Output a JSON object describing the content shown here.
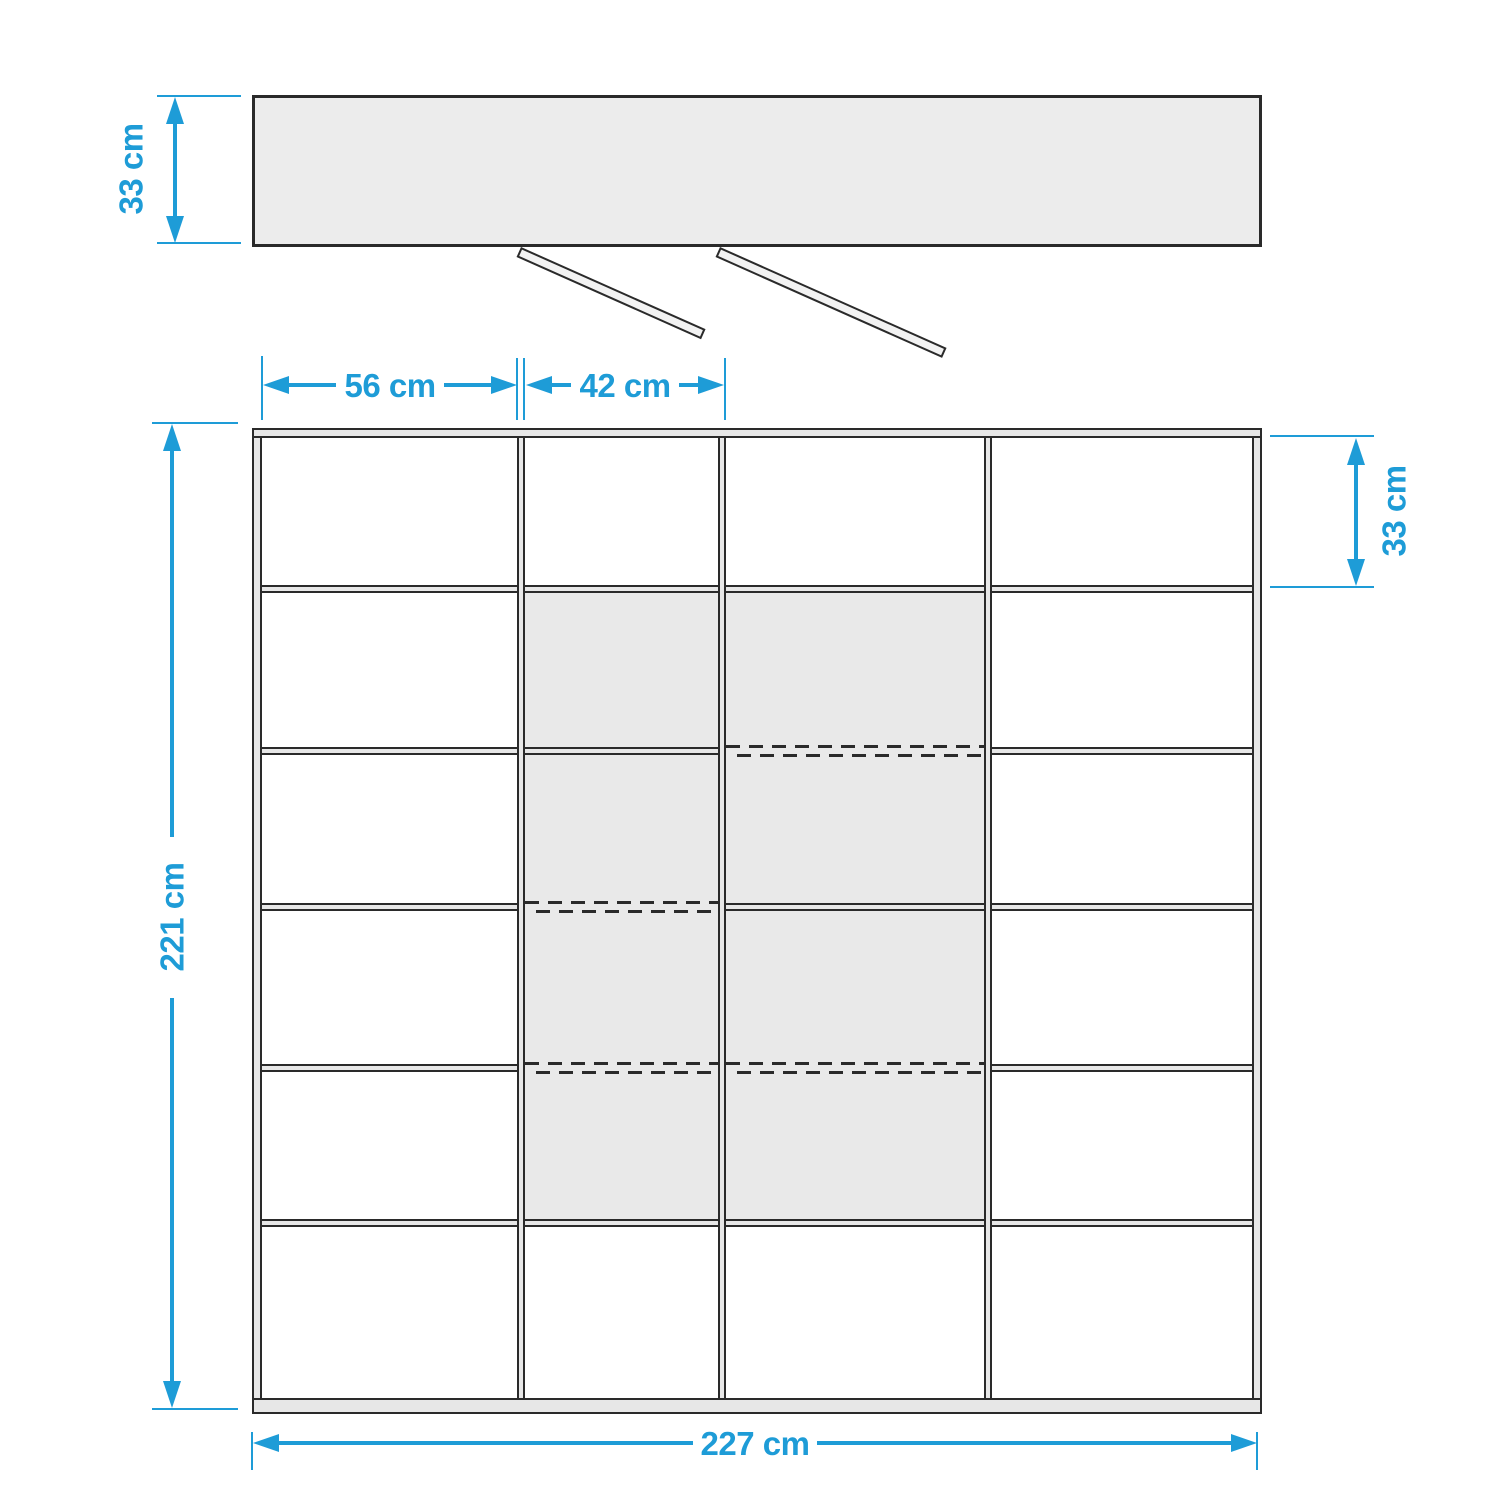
{
  "colors": {
    "accent_blue": "#1e9cd7",
    "outline_dark": "#2a2a2a",
    "panel_fill": "#e7e7e7",
    "shaded_compartment_fill": "#e9e9e9",
    "background": "#ffffff"
  },
  "top_view": {
    "description": "top view of cabinet carcass with two sliding doors shown open",
    "depth_dimension_label": "33 cm",
    "open_door_count": 2
  },
  "front_view": {
    "description": "front view of shelf unit grid",
    "grid": {
      "columns": 4,
      "rows": 6
    },
    "dimension_labels": {
      "column1_width": "56 cm",
      "column2_width": "42 cm",
      "top_row_height": "33 cm",
      "total_height": "221 cm",
      "total_width": "227 cm"
    },
    "shaded_compartments": {
      "columns": [
        2,
        3
      ],
      "rows": [
        2,
        3,
        4,
        5
      ]
    },
    "shelf_boundaries": [
      {
        "between_rows": "1-2",
        "styles_by_column": [
          "solid",
          "solid",
          "solid",
          "solid"
        ]
      },
      {
        "between_rows": "2-3",
        "styles_by_column": [
          "solid",
          "solid",
          "dashed",
          "solid"
        ]
      },
      {
        "between_rows": "3-4",
        "styles_by_column": [
          "solid",
          "dashed",
          "solid",
          "solid"
        ]
      },
      {
        "between_rows": "4-5",
        "styles_by_column": [
          "solid",
          "dashed",
          "dashed",
          "solid"
        ]
      },
      {
        "between_rows": "5-6",
        "styles_by_column": [
          "solid",
          "solid",
          "solid",
          "solid"
        ]
      }
    ]
  }
}
